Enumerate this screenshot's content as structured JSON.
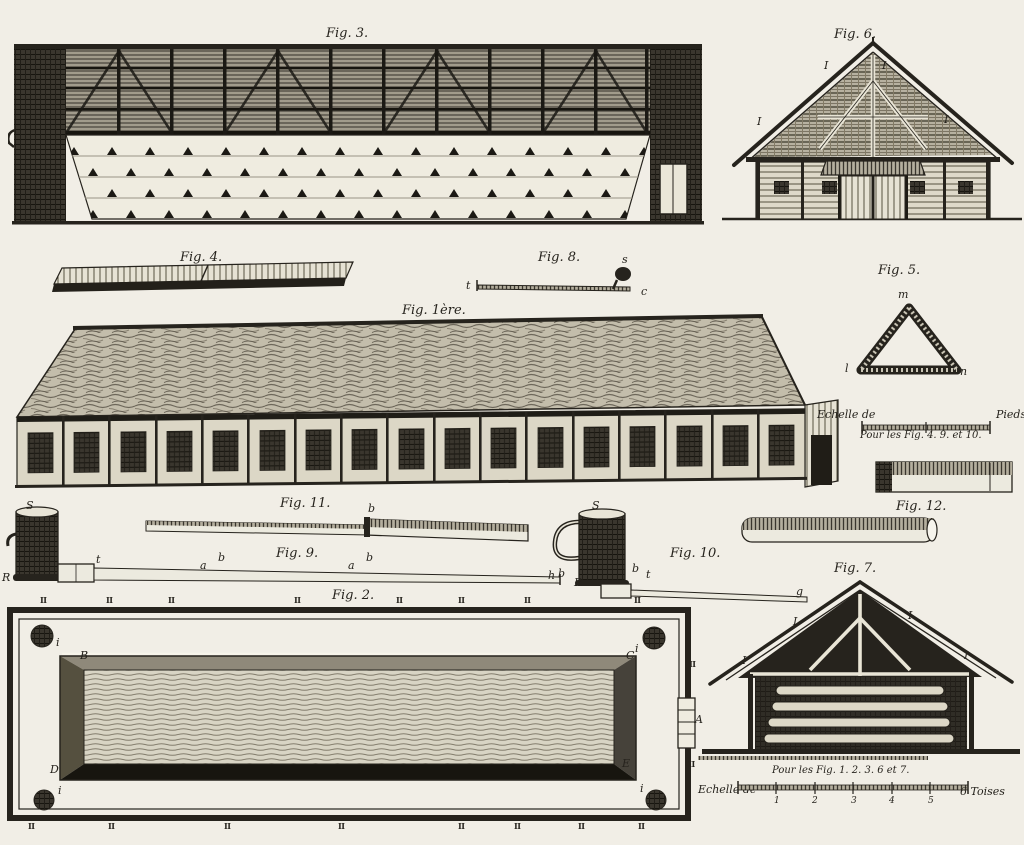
{
  "plate": {
    "paper": "#f1eee6",
    "ink": "#26231d"
  },
  "figures": {
    "fig1": {
      "label": "Fig. 1ère."
    },
    "fig2": {
      "label": "Fig. 2.",
      "corners": {
        "tl": "B",
        "tr": "C",
        "bl": "D",
        "br": "E"
      },
      "gate": "A",
      "post": "i",
      "edge_top": [
        "II",
        "II",
        "II",
        "II",
        "II",
        "II",
        "II",
        "II"
      ],
      "edge_bottom": [
        "II",
        "II",
        "II",
        "II",
        "II",
        "II",
        "II",
        "II"
      ],
      "edge_right_top": "II",
      "edge_right_bottom": "III"
    },
    "fig3": {
      "label": "Fig. 3."
    },
    "fig4": {
      "label": "Fig. 4."
    },
    "fig5": {
      "label": "Fig. 5.",
      "letters": {
        "top": "m",
        "left": "l",
        "right": "n"
      }
    },
    "fig6": {
      "label": "Fig. 6.",
      "letters": {
        "ul": "I",
        "ur": "I",
        "ll": "I",
        "lr": "I"
      }
    },
    "fig7": {
      "label": "Fig. 7.",
      "letters": {
        "ul": "I",
        "ur": "I",
        "ll": "I",
        "lr": "I"
      }
    },
    "fig8": {
      "label": "Fig. 8.",
      "letters": {
        "left": "t",
        "right": "c",
        "hook": "s"
      }
    },
    "fig9": {
      "label": "Fig. 9.",
      "letters": {
        "pot": "S",
        "elbow": "R",
        "start": "t",
        "a1": "a",
        "b1": "b",
        "a2": "a",
        "b2": "b",
        "end": "h"
      }
    },
    "fig10": {
      "label": "Fig. 10.",
      "letters": {
        "pot": "S",
        "b1": "b",
        "elbow": "R",
        "b2": "b",
        "t": "t",
        "end": "g"
      }
    },
    "fig11": {
      "label": "Fig. 11.",
      "letters": {
        "b": "b"
      }
    },
    "fig12": {
      "label": "Fig. 12."
    }
  },
  "scales": {
    "pieds": {
      "prefix": "Echelle de",
      "unit": "Pieds",
      "caption": "Pour les Fig. 4. 9. et 10."
    },
    "toises": {
      "prefix": "Echelle de",
      "unit": "6 Toises",
      "caption": "Pour les Fig. 1. 2. 3. 6 et 7.",
      "ticks": [
        "1",
        "2",
        "3",
        "4",
        "5"
      ]
    }
  }
}
